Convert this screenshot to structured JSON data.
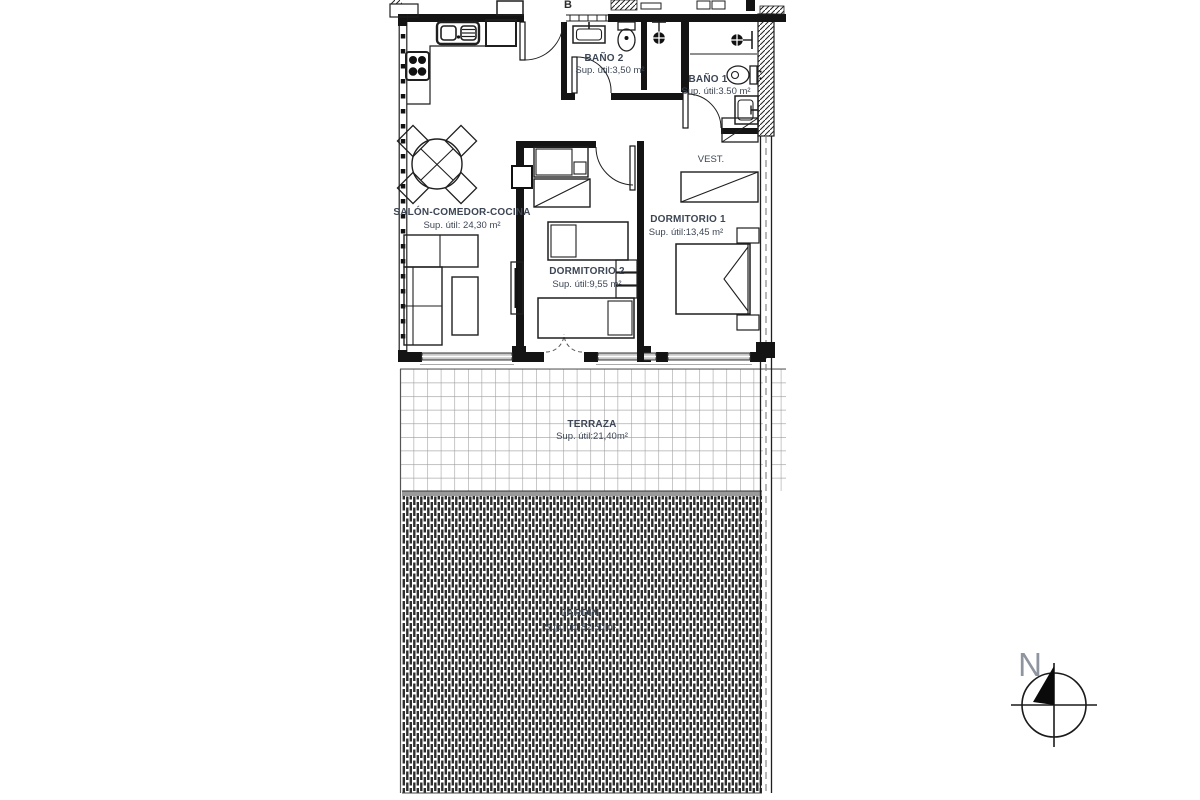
{
  "document": {
    "type_label": "apartment floor plan",
    "section_marker": "B"
  },
  "colors": {
    "line": "#1f1f1f",
    "label_text": "#3d4654",
    "grid_line": "#9b9b9b",
    "garden_hatch": "#2e2e2e",
    "window_fill": "#c8c8c8",
    "compass_n": "#8f959e"
  },
  "rooms": [
    {
      "id": "salon",
      "name": "SALÓN-COMEDOR-COCINA",
      "area": "Sup. útil: 24,30 m²"
    },
    {
      "id": "dormitorio2",
      "name": "DORMITORIO 2",
      "area": "Sup. útil:9,55 m²"
    },
    {
      "id": "dormitorio1",
      "name": "DORMITORIO 1",
      "area": "Sup. útil:13,45 m²"
    },
    {
      "id": "bano2",
      "name": "BAÑO 2",
      "area": "Sup. útil:3,50 m²"
    },
    {
      "id": "bano1",
      "name": "BAÑO 1",
      "area": "Sup. útil:3.50 m²"
    },
    {
      "id": "vestidor",
      "name": "VEST.",
      "area": ""
    },
    {
      "id": "terraza",
      "name": "TERRAZA",
      "area": "Sup. útil:21,40m²"
    },
    {
      "id": "jardin",
      "name": "JARDIN",
      "area": "Sup. útil:82,50m²"
    }
  ],
  "compass": {
    "label": "N"
  }
}
